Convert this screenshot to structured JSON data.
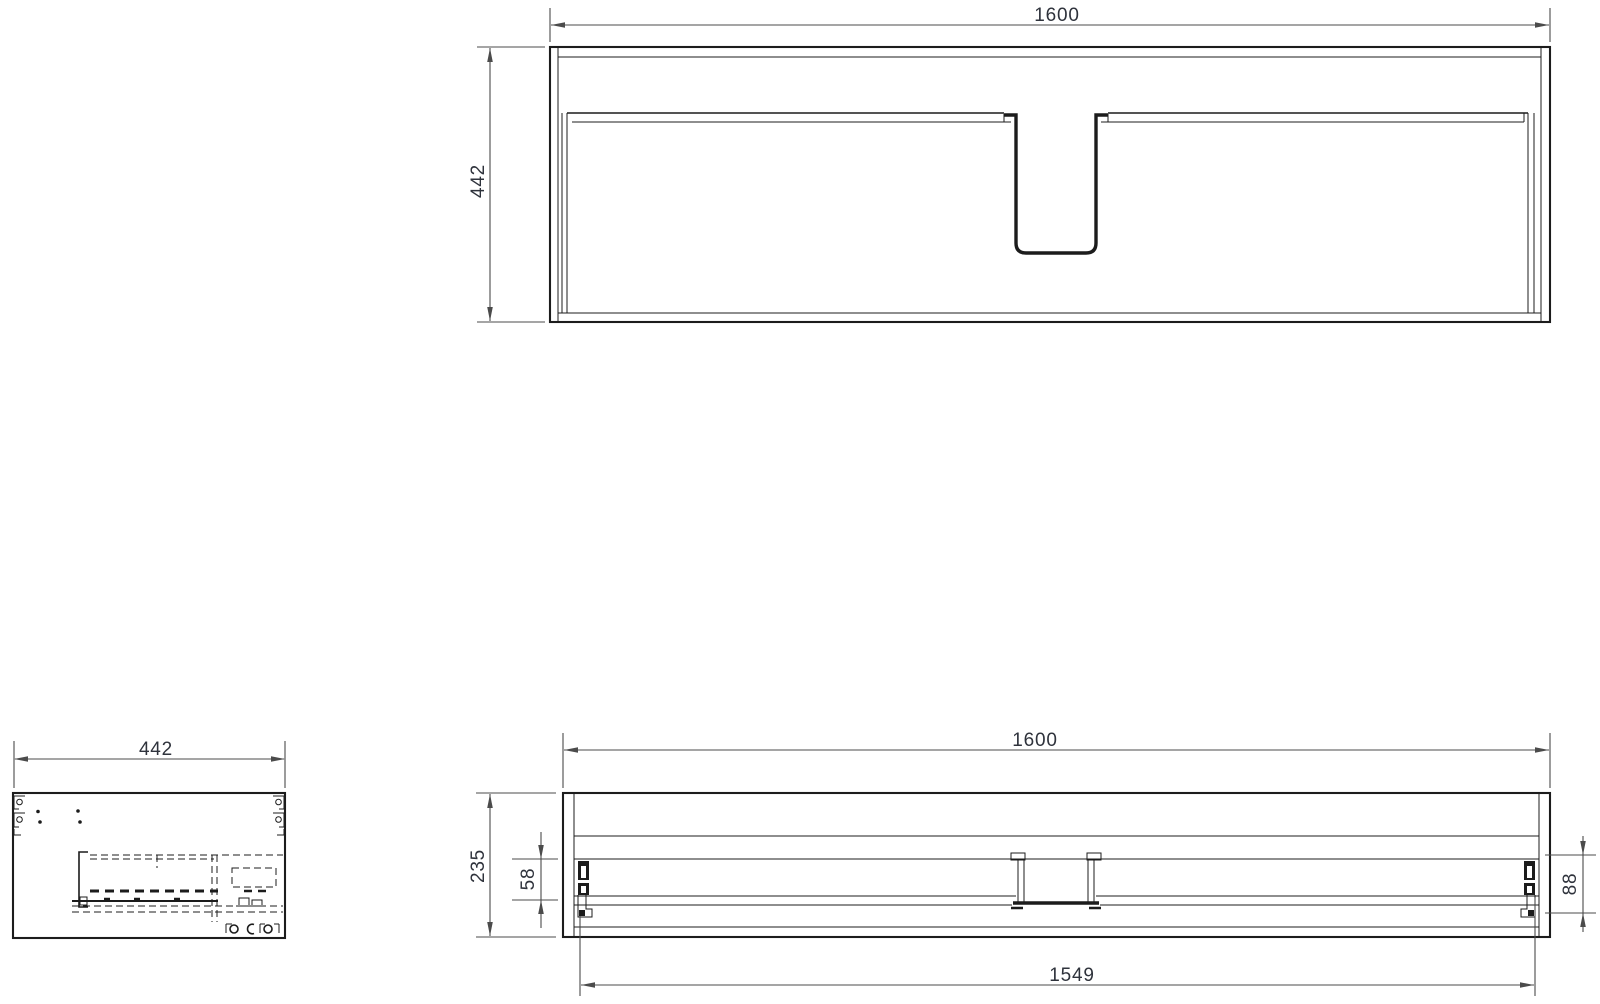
{
  "page": {
    "background": "#ffffff",
    "description": "cabinet-technical-drawing"
  },
  "colors": {
    "line": "#1c1c1c",
    "dim": "#4b4b4b",
    "text": "#2f333c"
  },
  "views": {
    "top": {
      "label": "top-view",
      "dimensions": {
        "width": "1600",
        "depth": "442"
      }
    },
    "side": {
      "label": "side-view",
      "dimensions": {
        "depth": "442"
      }
    },
    "front": {
      "label": "front-view",
      "dimensions": {
        "width": "1600",
        "height": "235",
        "drawer_front_offset": "58",
        "slide_bracket_height": "88",
        "carcass_inner_width": "1549"
      }
    }
  }
}
